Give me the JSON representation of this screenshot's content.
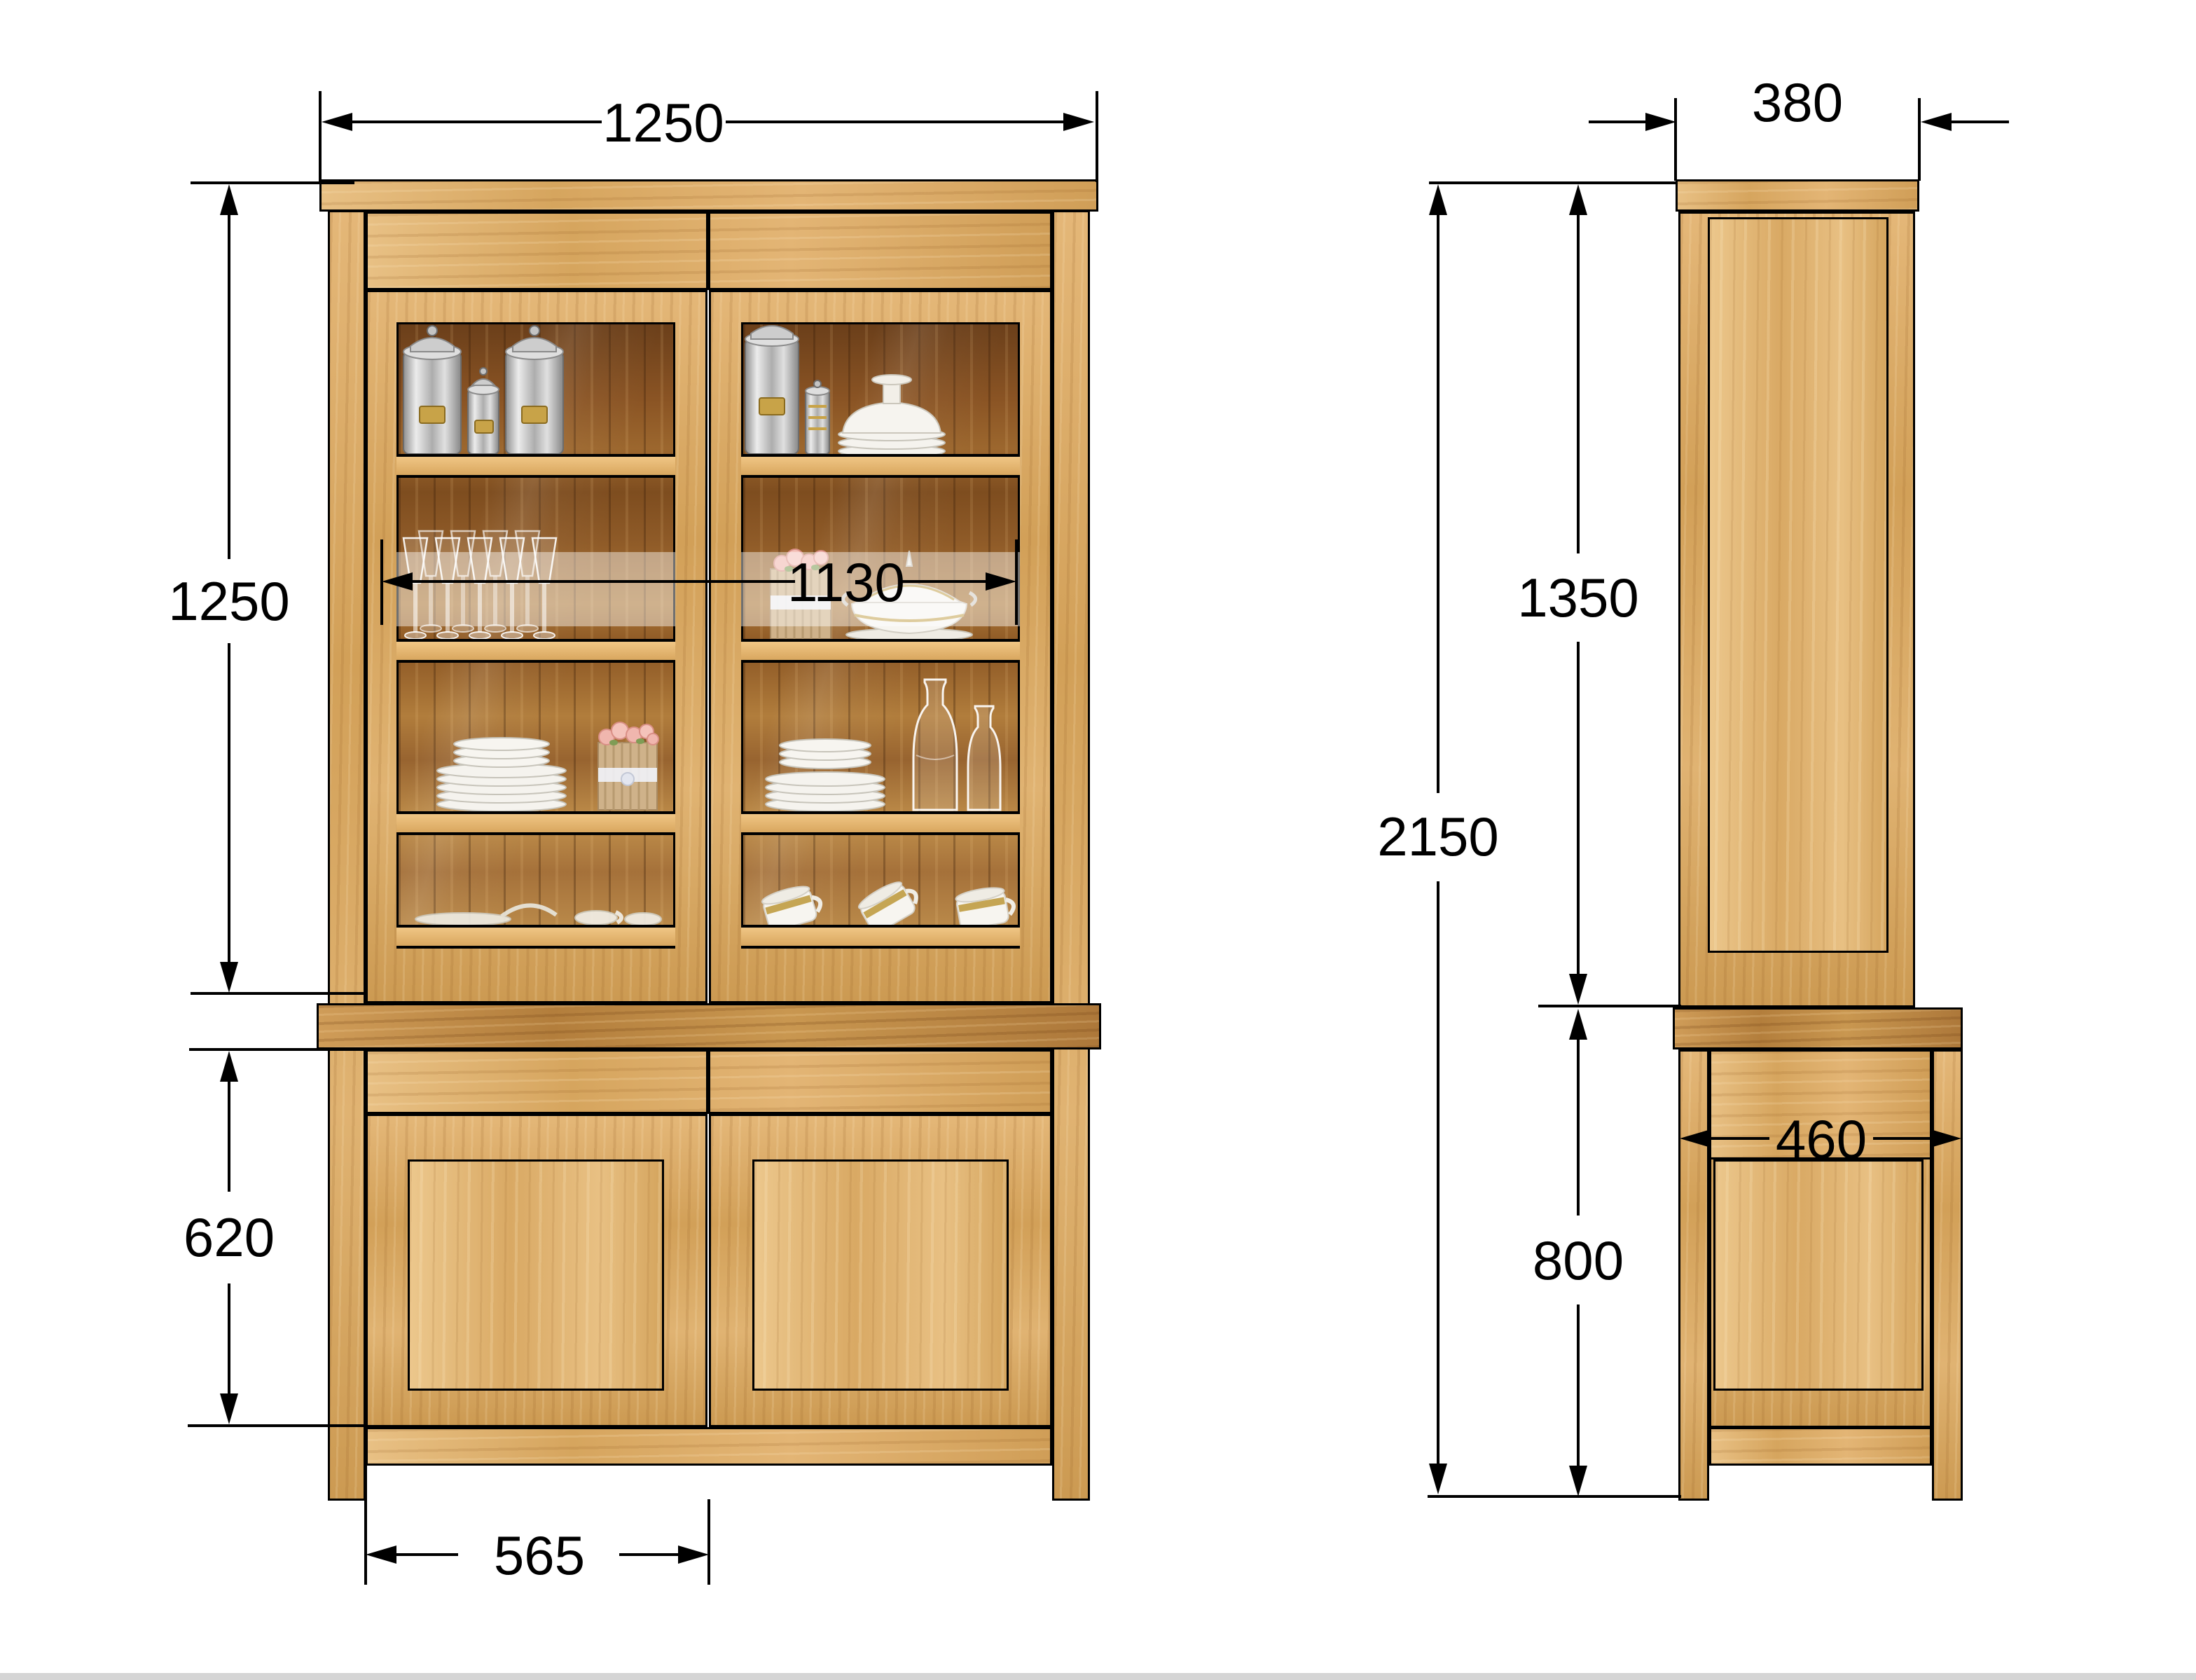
{
  "page": {
    "background_color": "#ffffff",
    "bottom_strip_color": "#d5d5d5"
  },
  "drawing": {
    "type": "furniture dimensioned elevation drawing",
    "subject": "oak buffet vitrine with glass display top and two-door base",
    "units": "mm",
    "line_color": "#000000",
    "wood_color": "#dcae6b",
    "front_view": {
      "name": "front-elevation",
      "dim_overall_width": "1250",
      "dim_upper_height": "1250",
      "dim_glass_interior_width": "1130",
      "dim_lower_height": "620",
      "dim_door_width": "565",
      "shelf_contents": {
        "left_door": [
          "three aluminium canisters",
          "stemware glasses",
          "stacked plates and rose box",
          "plate and cups"
        ],
        "right_door": [
          "canister and pedestal bowl stack",
          "rose box and gold-trim soup tureen",
          "stacked plates and two glass carafes",
          "three gold-rimmed cups"
        ]
      }
    },
    "side_view": {
      "name": "side-elevation",
      "dim_upper_depth": "380",
      "dim_upper_height": "1350",
      "dim_total_height": "2150",
      "dim_lower_depth": "460",
      "dim_lower_height": "800"
    }
  }
}
